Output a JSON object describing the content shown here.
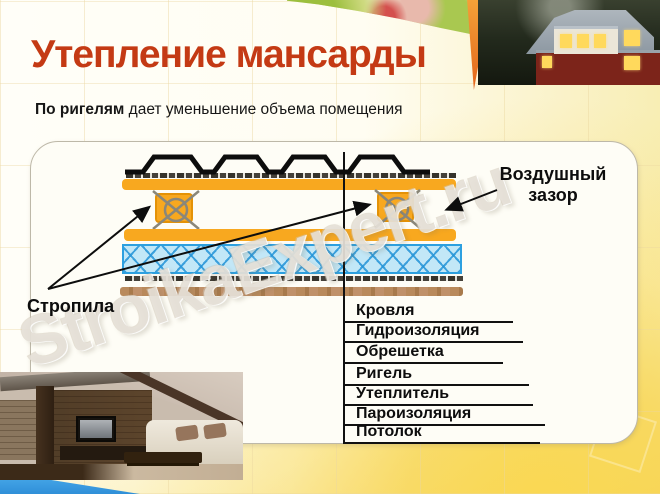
{
  "slide": {
    "title": "Утепление мансарды",
    "subtitle": {
      "bold": "По ригелям",
      "rest": " дает уменьшение объема помещения"
    },
    "watermark": "StroikaExpert.ru"
  },
  "diagram": {
    "rafters_label": "Стропила",
    "air_gap_label_line1": "Воздушный",
    "air_gap_label_line2": "зазор",
    "legend": [
      "Кровля",
      "Гидроизоляция",
      "Обрешетка",
      "Ригель",
      "Утеплитель",
      "Пароизоляция",
      "Потолок"
    ]
  },
  "colors": {
    "title_red": "#c43a14",
    "batten_orange": "#f8a81f",
    "insulation_blue_fill": "#c2e7f7",
    "insulation_blue_line": "#2da0e0",
    "ceiling_brown": "#b98a5c",
    "membrane_dark": "#36332c",
    "corner_blue": "#3aa0e8",
    "background_gold": "#f8d654"
  },
  "images": {
    "house_photo": "house-at-dusk-photo",
    "interior_photo": "attic-interior-photo",
    "fruit_banner": "fruit-banner-image"
  }
}
